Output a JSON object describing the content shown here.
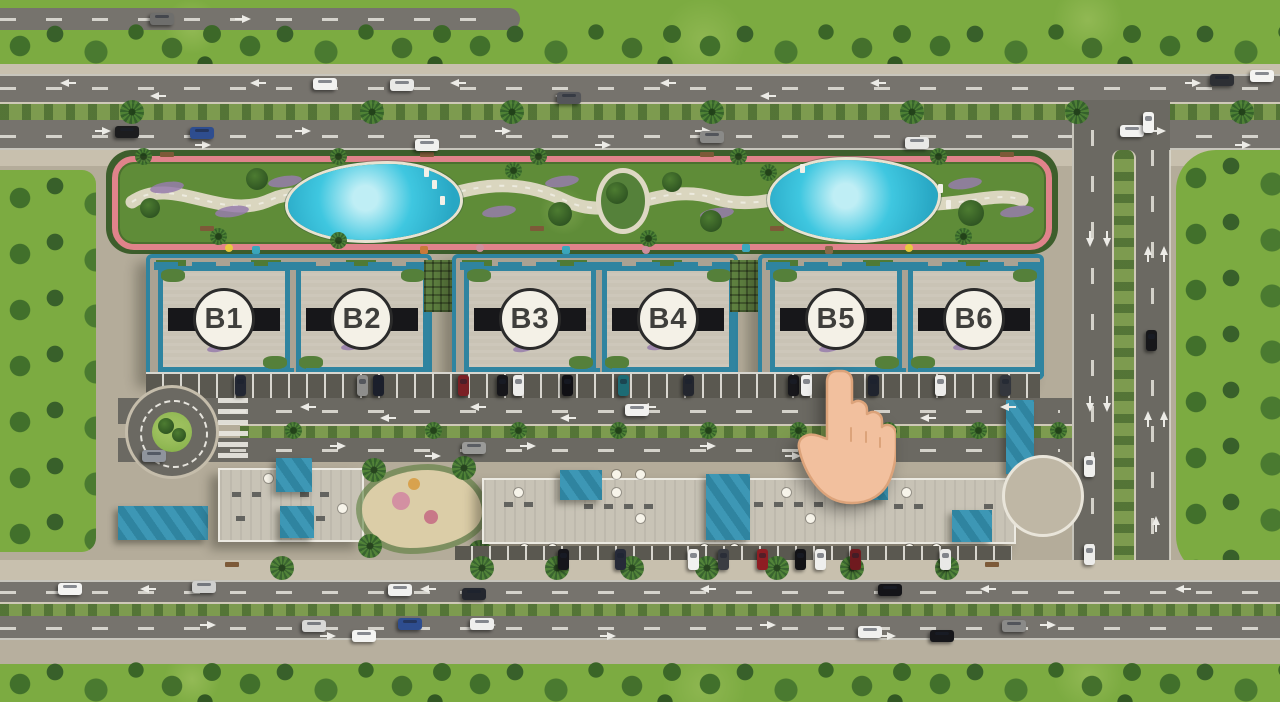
{
  "scene": {
    "type": "residential-compound-masterplan-render",
    "buildings": [
      {
        "id": "b1",
        "label": "B1"
      },
      {
        "id": "b2",
        "label": "B2"
      },
      {
        "id": "b3",
        "label": "B3"
      },
      {
        "id": "b4",
        "label": "B4"
      },
      {
        "id": "b5",
        "label": "B5"
      },
      {
        "id": "b6",
        "label": "B6"
      }
    ],
    "cursor": {
      "icon": "pointing-hand-icon",
      "near_building": "B5"
    },
    "colors": {
      "pool": "#3fc7e0",
      "pool_deep": "#28a7c4",
      "track": "#e0838b",
      "teal": "#2f84a0",
      "teal_light": "#3d97b5",
      "roof": "#c9c3b5",
      "grass": "#7cab41",
      "lawn": "#5f8c38",
      "hedge": "#3d5e2c",
      "road": "#76736d",
      "road_dark": "#6b6962",
      "asphalt": "#5a5850",
      "sidewalk": "#c8c0ae",
      "pavement": "#b4ac9a",
      "sand": "#dbcda7",
      "median_green": "#7d9b4f",
      "hand": "#f2c09e",
      "hand_shade": "#dca37a",
      "circle_bg": "#f4f1e7",
      "circle_border": "#2b2b2b",
      "label_text": "#3f3f3c",
      "flower": "#967cab"
    }
  }
}
